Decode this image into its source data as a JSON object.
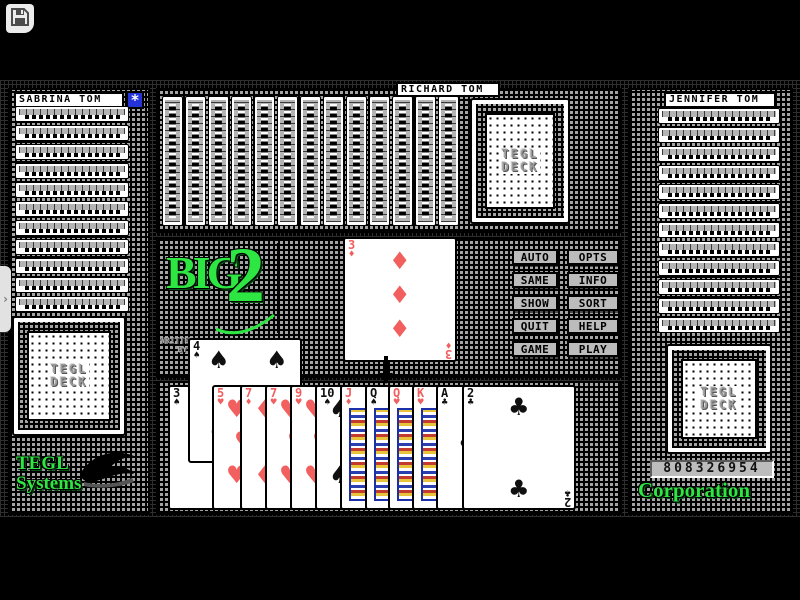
{
  "window": {
    "save_button": {
      "icon": "floppy-disk-icon"
    },
    "side_tab_glyph": "›"
  },
  "players": {
    "left": {
      "name": "SABRINA TOM",
      "cards_remaining": 11
    },
    "top": {
      "name": "RICHARD TOM",
      "cards_remaining": 13
    },
    "right": {
      "name": "JENNIFER TOM",
      "cards_remaining": 12
    },
    "bottom": {
      "hand": [
        {
          "rank": "3",
          "suit": "spade"
        },
        {
          "rank": "4",
          "suit": "spade",
          "raised": true
        },
        {
          "rank": "5",
          "suit": "heart"
        },
        {
          "rank": "7",
          "suit": "diamond"
        },
        {
          "rank": "7",
          "suit": "heart"
        },
        {
          "rank": "9",
          "suit": "heart"
        },
        {
          "rank": "10",
          "suit": "spade"
        },
        {
          "rank": "J",
          "suit": "diamond",
          "face": true
        },
        {
          "rank": "Q",
          "suit": "spade",
          "face": true
        },
        {
          "rank": "Q",
          "suit": "heart",
          "face": true
        },
        {
          "rank": "K",
          "suit": "heart",
          "face": true
        },
        {
          "rank": "A",
          "suit": "club"
        },
        {
          "rank": "2",
          "suit": "club"
        }
      ]
    }
  },
  "played_card": {
    "rank": "3",
    "suit": "diamond"
  },
  "deck": {
    "line1": "TEGL",
    "line2": "DECK"
  },
  "star_button": {
    "glyph": "*",
    "icon": "star-icon"
  },
  "logo": {
    "word": "BIG",
    "numeral": "2",
    "credit_line1": "WRITTEN",
    "credit_line2": "BY"
  },
  "buttons": [
    "AUTO",
    "OPTS",
    "SAME",
    "INFO",
    "SHOW",
    "SORT",
    "QUIT",
    "HELP",
    "GAME",
    "PLAY"
  ],
  "branding": {
    "company_line1": "TEGL",
    "company_line2": "Systems",
    "company_line3": "Corporation",
    "score": "808326954"
  },
  "colors": {
    "green": "#2ee642",
    "blue": "#2433d8",
    "red": "#f25f5f",
    "panel_gray": "#a4a4a4",
    "button_gray": "#bcbcbc"
  }
}
